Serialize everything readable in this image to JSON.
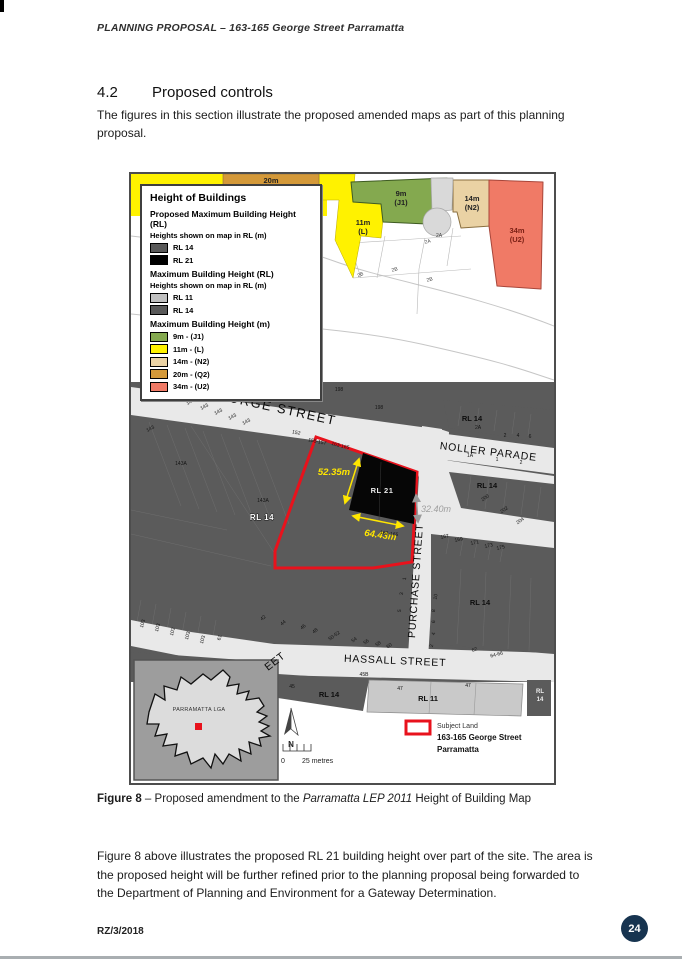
{
  "page": {
    "header_title": "PLANNING PROPOSAL – 163-165 George Street Parramatta",
    "section_number": "4.2",
    "section_title": "Proposed controls",
    "intro": "The figures in this section illustrate the proposed amended maps as part of this planning proposal.",
    "caption": {
      "label": "Figure 8",
      "rest1": " – Proposed amendment to the ",
      "italic": "Parramatta LEP 2011",
      "rest2": " Height of Building Map"
    },
    "body": "Figure 8 above illustrates the proposed RL 21 building height over part of the site. The area is the proposed height will be further refined prior to the planning proposal being forwarded to the Department of Planning and Environment for a Gateway Determination.",
    "footer_ref": "RZ/3/2018",
    "page_number": "24"
  },
  "colors": {
    "subject_land_red": "#e8121c",
    "rl21_black": "#060606",
    "urban_grey": "#5b5b5b",
    "street_grey": "#e9e9e9",
    "page_badge_navy": "#173450",
    "zone_yellow": "#fff200",
    "zone_green": "#84a94f",
    "zone_tan": "#ead2a4",
    "zone_orange": "#d49939",
    "zone_salmon": "#f07a66"
  },
  "map": {
    "legend": {
      "title": "Height of Buildings",
      "sections": [
        {
          "heading": "Proposed Maximum Building Height (RL)",
          "subheading": "Heights shown on map in RL (m)",
          "items": [
            {
              "swatch": "#595959",
              "label": "RL 14"
            },
            {
              "swatch": "#000000",
              "label": "RL 21"
            }
          ]
        },
        {
          "heading": "Maximum Building Height (RL)",
          "subheading": "Heights shown on map in RL (m)",
          "items": [
            {
              "swatch": "#c0c0c0",
              "label": "RL 11"
            },
            {
              "swatch": "#595959",
              "label": "RL 14"
            }
          ]
        },
        {
          "heading": "Maximum Building Height (m)",
          "subheading": "",
          "items": [
            {
              "swatch": "#84a94f",
              "label": "9m - (J1)"
            },
            {
              "swatch": "#fff200",
              "label": "11m - (L)"
            },
            {
              "swatch": "#ead2a4",
              "label": "14m - (N2)"
            },
            {
              "swatch": "#d49939",
              "label": "20m - (Q2)"
            },
            {
              "swatch": "#f07a66",
              "label": "34m - (U2)"
            }
          ]
        }
      ]
    },
    "key": {
      "subject": "Subject Land",
      "line1": "163-165 George Street",
      "line2": "Parramatta"
    },
    "dimensions": {
      "west": "52.35m",
      "south": "64.43m",
      "east": "32.40m"
    },
    "svg_labels": [
      {
        "t": "GEORGE STREET",
        "x": 140,
        "y": 237,
        "r": 12.5,
        "c": "st-lg"
      },
      {
        "t": "NOLLER PARADE",
        "x": 357,
        "y": 281,
        "r": 7,
        "c": "st-md"
      },
      {
        "t": "PURCHASE STREET",
        "x": 288,
        "y": 407,
        "r": -86,
        "c": "st-md"
      },
      {
        "t": "HASSALL STREET",
        "x": 264,
        "y": 490,
        "r": 2.5,
        "c": "st-md"
      },
      {
        "t": "EET",
        "x": 146,
        "y": 490,
        "r": -38,
        "c": "st-md"
      },
      {
        "t": "20m",
        "x": 140,
        "y": 9,
        "c": "zone"
      },
      {
        "t": "9m",
        "x": 270,
        "y": 22,
        "c": "zone"
      },
      {
        "t": "(J1)",
        "x": 270,
        "y": 31,
        "c": "zone"
      },
      {
        "t": "11m",
        "x": 232,
        "y": 51,
        "c": "zone"
      },
      {
        "t": "(L)",
        "x": 232,
        "y": 60,
        "c": "zone"
      },
      {
        "t": "14m",
        "x": 341,
        "y": 27,
        "c": "zone"
      },
      {
        "t": "(N2)",
        "x": 341,
        "y": 36,
        "c": "zone"
      },
      {
        "t": "34m",
        "x": 386,
        "y": 59,
        "c": "zone-red"
      },
      {
        "t": "(U2)",
        "x": 386,
        "y": 68,
        "c": "zone-red"
      },
      {
        "t": "2A",
        "x": 297,
        "y": 69,
        "r": -15,
        "c": "pc"
      },
      {
        "t": "2A",
        "x": 308,
        "y": 63,
        "c": "pc"
      },
      {
        "t": "2B",
        "x": 230,
        "y": 102,
        "r": -25,
        "c": "pc"
      },
      {
        "t": "2B",
        "x": 264,
        "y": 97,
        "r": -15,
        "c": "pc"
      },
      {
        "t": "2B",
        "x": 299,
        "y": 107,
        "r": -15,
        "c": "pc"
      },
      {
        "t": "RL 14",
        "x": 341,
        "y": 247,
        "c": "rl-dk"
      },
      {
        "t": "RL 14",
        "x": 356,
        "y": 314,
        "c": "rl-dk"
      },
      {
        "t": "RL 14",
        "x": 349,
        "y": 431,
        "c": "rl-dk"
      },
      {
        "t": "RL 14",
        "x": 131,
        "y": 346,
        "c": "rl-wt"
      },
      {
        "t": "RL 21",
        "x": 251,
        "y": 319,
        "c": "rl-21"
      },
      {
        "t": "RL 14",
        "x": 198,
        "y": 523,
        "c": "rl-dk"
      },
      {
        "t": "RL 11",
        "x": 297,
        "y": 527,
        "c": "rl-dk"
      },
      {
        "t": "RL",
        "x": 409,
        "y": 519,
        "c": "rl-sm"
      },
      {
        "t": "14",
        "x": 409,
        "y": 527,
        "c": "rl-sm"
      },
      {
        "t": "52.35m",
        "x": 203,
        "y": 301,
        "c": "dim-y"
      },
      {
        "t": "64.43m",
        "x": 249,
        "y": 364,
        "r": 8,
        "c": "dim-y"
      },
      {
        "t": "32.40m",
        "x": 290,
        "y": 338,
        "c": "dim-g"
      },
      {
        "t": "163-165",
        "x": 209,
        "y": 273,
        "r": 14,
        "c": "pc-d"
      },
      {
        "t": "163-165",
        "x": 258,
        "y": 361,
        "r": 8,
        "c": "pc-d"
      },
      {
        "t": "196",
        "x": 143,
        "y": 219,
        "c": "pc-d"
      },
      {
        "t": "198",
        "x": 208,
        "y": 217,
        "c": "pc-d"
      },
      {
        "t": "198",
        "x": 248,
        "y": 235,
        "c": "pc-d"
      },
      {
        "t": "143",
        "x": 20,
        "y": 256,
        "r": -28,
        "c": "pc-d"
      },
      {
        "t": "143",
        "x": 60,
        "y": 229,
        "r": -28,
        "c": "pc-d"
      },
      {
        "t": "143",
        "x": 74,
        "y": 234,
        "r": -28,
        "c": "pc-d"
      },
      {
        "t": "143",
        "x": 88,
        "y": 239,
        "r": -28,
        "c": "pc-d"
      },
      {
        "t": "143",
        "x": 102,
        "y": 244,
        "r": -28,
        "c": "pc-d"
      },
      {
        "t": "143",
        "x": 116,
        "y": 249,
        "r": -28,
        "c": "pc-d"
      },
      {
        "t": "152",
        "x": 165,
        "y": 260,
        "r": 12,
        "c": "pc-d"
      },
      {
        "t": "155-157",
        "x": 186,
        "y": 269,
        "r": 12,
        "c": "pc-d"
      },
      {
        "t": "143A",
        "x": 50,
        "y": 291,
        "c": "pc-d"
      },
      {
        "t": "143A",
        "x": 132,
        "y": 328,
        "c": "pc-d"
      },
      {
        "t": "103",
        "x": 13,
        "y": 450,
        "r": -75,
        "c": "pc-d"
      },
      {
        "t": "103",
        "x": 28,
        "y": 454,
        "r": -75,
        "c": "pc-d"
      },
      {
        "t": "103",
        "x": 43,
        "y": 458,
        "r": -75,
        "c": "pc-d"
      },
      {
        "t": "103",
        "x": 58,
        "y": 462,
        "r": -75,
        "c": "pc-d"
      },
      {
        "t": "103",
        "x": 73,
        "y": 466,
        "r": -75,
        "c": "pc-d"
      },
      {
        "t": "61",
        "x": 90,
        "y": 464,
        "r": -75,
        "c": "pc-d"
      },
      {
        "t": "42",
        "x": 133,
        "y": 445,
        "r": -40,
        "c": "pc-d"
      },
      {
        "t": "44",
        "x": 153,
        "y": 450,
        "r": -40,
        "c": "pc-d"
      },
      {
        "t": "46",
        "x": 173,
        "y": 454,
        "r": -40,
        "c": "pc-d"
      },
      {
        "t": "48",
        "x": 185,
        "y": 458,
        "r": -40,
        "c": "pc-d"
      },
      {
        "t": "50-52",
        "x": 204,
        "y": 463,
        "r": -35,
        "c": "pc-d"
      },
      {
        "t": "54",
        "x": 224,
        "y": 467,
        "r": -35,
        "c": "pc-d"
      },
      {
        "t": "56",
        "x": 236,
        "y": 469,
        "r": -35,
        "c": "pc-d"
      },
      {
        "t": "58",
        "x": 248,
        "y": 471,
        "r": -35,
        "c": "pc-d"
      },
      {
        "t": "60",
        "x": 259,
        "y": 473,
        "r": -35,
        "c": "pc-d"
      },
      {
        "t": "62",
        "x": 344,
        "y": 477,
        "r": -20,
        "c": "pc-d"
      },
      {
        "t": "64-66",
        "x": 366,
        "y": 482,
        "r": -15,
        "c": "pc-d"
      },
      {
        "t": "45B",
        "x": 233,
        "y": 502,
        "c": "pc-d"
      },
      {
        "t": "45",
        "x": 161,
        "y": 514,
        "c": "pc-d"
      },
      {
        "t": "47",
        "x": 269,
        "y": 516,
        "c": "pc-d"
      },
      {
        "t": "47",
        "x": 337,
        "y": 513,
        "c": "pc-d"
      },
      {
        "t": "1",
        "x": 275,
        "y": 405,
        "r": -80,
        "c": "pc-d"
      },
      {
        "t": "3",
        "x": 272,
        "y": 420,
        "r": -80,
        "c": "pc-d"
      },
      {
        "t": "5",
        "x": 270,
        "y": 437,
        "r": -80,
        "c": "pc-d"
      },
      {
        "t": "10",
        "x": 306,
        "y": 423,
        "r": -80,
        "c": "pc-d"
      },
      {
        "t": "8",
        "x": 304,
        "y": 437,
        "r": -80,
        "c": "pc-d"
      },
      {
        "t": "6",
        "x": 304,
        "y": 448,
        "r": -80,
        "c": "pc-d"
      },
      {
        "t": "4",
        "x": 304,
        "y": 460,
        "r": -80,
        "c": "pc-d"
      },
      {
        "t": "2",
        "x": 302,
        "y": 472,
        "r": -80,
        "c": "pc-d"
      },
      {
        "t": "1A",
        "x": 339,
        "y": 283,
        "c": "pc-d"
      },
      {
        "t": "1",
        "x": 366,
        "y": 287,
        "c": "pc-d"
      },
      {
        "t": "2",
        "x": 390,
        "y": 290,
        "c": "pc-d"
      },
      {
        "t": "2A",
        "x": 347,
        "y": 255,
        "c": "pc-d"
      },
      {
        "t": "2",
        "x": 374,
        "y": 263,
        "c": "pc-d"
      },
      {
        "t": "4",
        "x": 387,
        "y": 263,
        "c": "pc-d"
      },
      {
        "t": "6",
        "x": 399,
        "y": 264,
        "c": "pc-d"
      },
      {
        "t": "200",
        "x": 355,
        "y": 325,
        "r": -35,
        "c": "pc-d"
      },
      {
        "t": "202",
        "x": 374,
        "y": 337,
        "r": -35,
        "c": "pc-d"
      },
      {
        "t": "204",
        "x": 390,
        "y": 348,
        "r": -35,
        "c": "pc-d"
      },
      {
        "t": "167",
        "x": 314,
        "y": 364,
        "r": -12,
        "c": "pc-d"
      },
      {
        "t": "169",
        "x": 328,
        "y": 367,
        "r": -12,
        "c": "pc-d"
      },
      {
        "t": "171",
        "x": 344,
        "y": 370,
        "r": -12,
        "c": "pc-d"
      },
      {
        "t": "173",
        "x": 358,
        "y": 373,
        "r": -12,
        "c": "pc-d"
      },
      {
        "t": "175",
        "x": 370,
        "y": 375,
        "r": -12,
        "c": "pc-d"
      },
      {
        "t": "PARRAMATTA LGA",
        "x": 68,
        "y": 537,
        "c": "inset-t"
      },
      {
        "t": "N",
        "x": 160,
        "y": 573,
        "c": "north-t"
      },
      {
        "t": "0",
        "x": 150,
        "y": 589,
        "c": "scale-t"
      },
      {
        "t": "25 metres",
        "x": 171,
        "y": 589,
        "c": "scale-t"
      },
      {
        "t": "Subject Land",
        "x": 306,
        "y": 554,
        "c": "key-sub"
      },
      {
        "t": "163-165 George Street",
        "x": 306,
        "y": 566,
        "c": "key-b"
      },
      {
        "t": "Parramatta",
        "x": 306,
        "y": 578,
        "c": "key-b"
      }
    ]
  }
}
